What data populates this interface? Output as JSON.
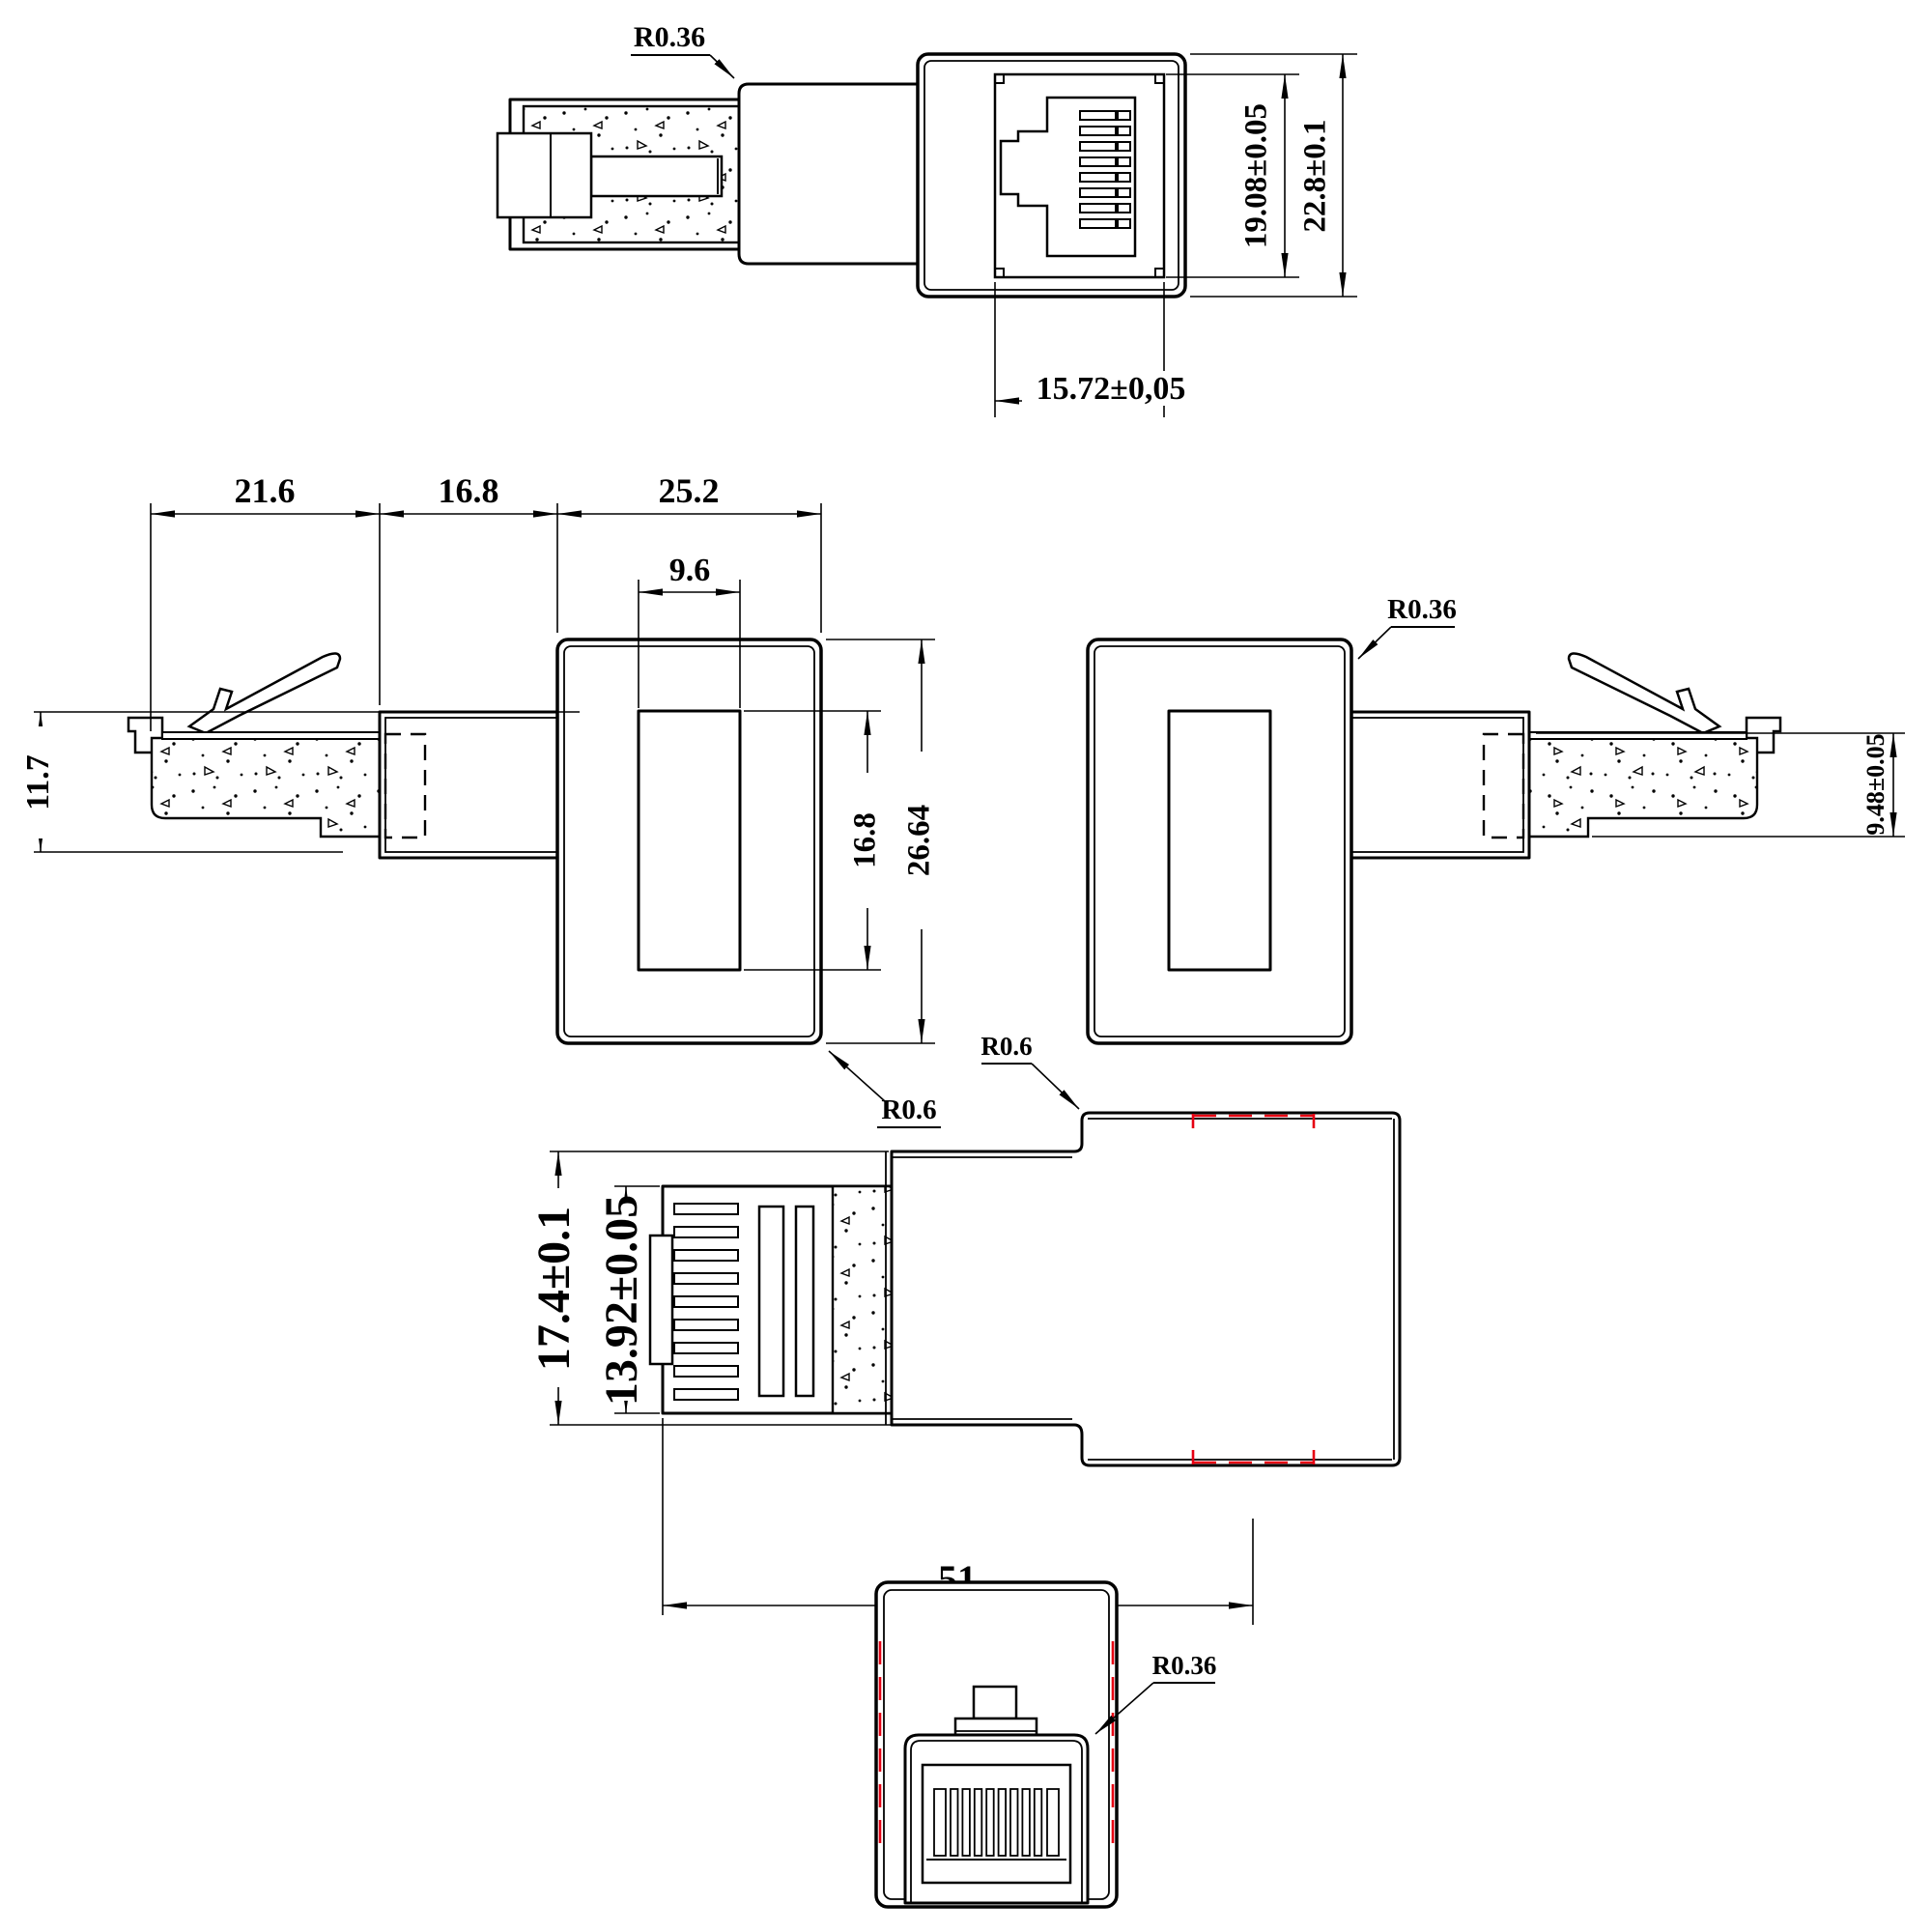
{
  "colors": {
    "line": "#000000",
    "hidden_red": "#e60012",
    "background": "#ffffff"
  },
  "top_view": {
    "fillet": "R0.36",
    "jack_opening_height": "19.08±0.05",
    "overall_height": "22.8±0.1",
    "jack_opening_width": "15.72±0,05"
  },
  "side_view": {
    "plug_length": "21.6",
    "neck_length": "16.8",
    "head_length": "25.2",
    "window_width": "9.6",
    "plug_height": "11.7",
    "window_height": "16.8",
    "head_height": "26.64",
    "fillet": "R0.6"
  },
  "side_view_mirrored": {
    "fillet": "R0.36",
    "plug_height": "9.48±0.05"
  },
  "rotated_view": {
    "fillet": "R0.6",
    "overall_height": "17.4±0.1",
    "plug_width": "13.92±0.05",
    "overall_length": "51"
  },
  "front_view": {
    "fillet": "R0.36"
  }
}
